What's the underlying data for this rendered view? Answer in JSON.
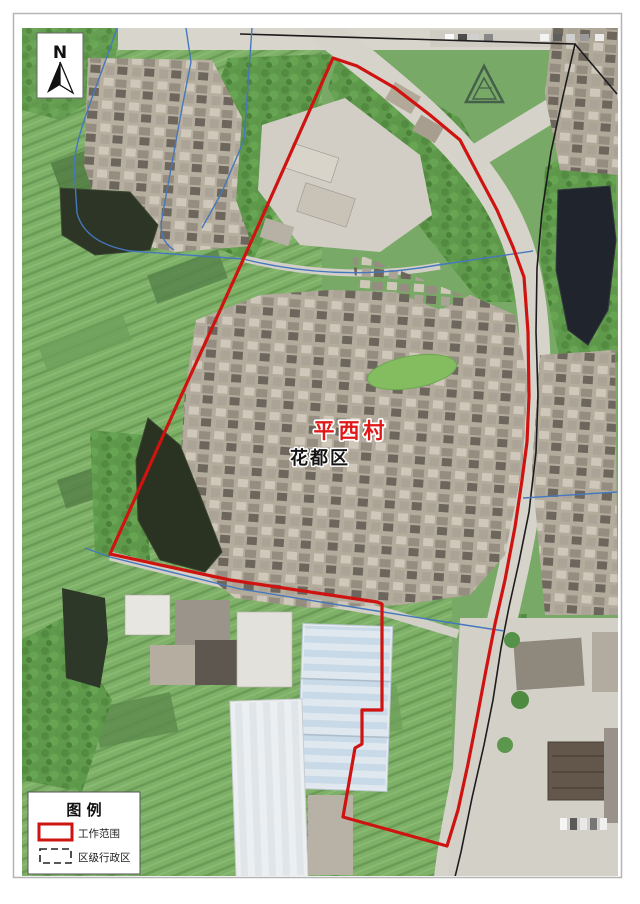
{
  "compass": {
    "label": "N"
  },
  "labels": {
    "village": "平西村",
    "district": "花都区"
  },
  "legend": {
    "title": "图  例",
    "items": [
      {
        "label": "工作范围",
        "swatch": "red-rectangle"
      },
      {
        "label": "区级行政区",
        "swatch": "black-dashed-rectangle"
      }
    ]
  },
  "colors": {
    "work_boundary": "#cf1310",
    "admin_line": "#4678bd",
    "road_line": "#1c1c1c",
    "village_label": "#e01818",
    "district_label": "#151515"
  }
}
